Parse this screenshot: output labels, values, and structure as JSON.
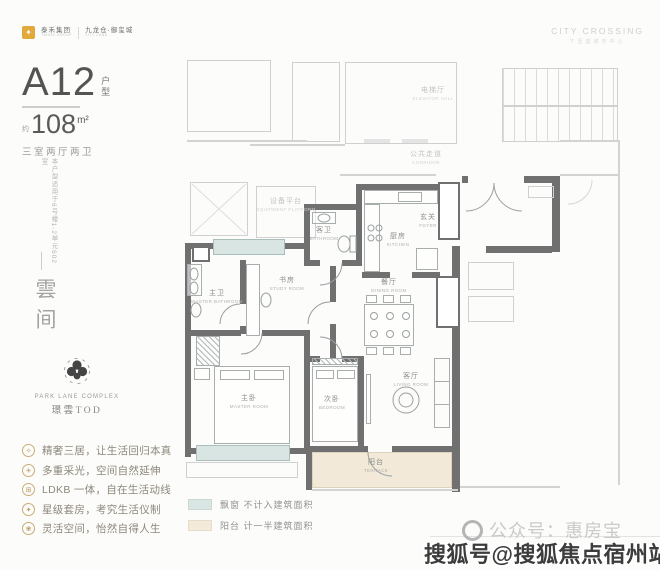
{
  "brand": {
    "logo_glyph": "✦",
    "dev_name": "泰禾集团",
    "dev_sub": "TAHOE GROUP",
    "project_name": "九龙仓·御玺城",
    "project_sub": "CITY LAND",
    "right_en": "CITY CROSSING",
    "right_cn": "下壹座城市中心"
  },
  "title": {
    "model": "A12",
    "model_tag_1": "户",
    "model_tag_2": "型",
    "approx": "约",
    "area": "108",
    "unit": "m²",
    "layout": "三室两厅两卫"
  },
  "side": {
    "note": "本户型适用于6号楼1-2单元602室",
    "name": "雲间"
  },
  "park": {
    "en": "PARK LANE COMPLEX",
    "cn": "璟雲TOD"
  },
  "features": [
    {
      "icon": "✧",
      "text": "精奢三居，让生活回归本真"
    },
    {
      "icon": "☀",
      "text": "多重采光，空间自然延伸"
    },
    {
      "icon": "⊞",
      "text": "LDKB 一体，自在生活动线"
    },
    {
      "icon": "✦",
      "text": "星级套房，考究生活仪制"
    },
    {
      "icon": "❀",
      "text": "灵活空间，怡然自得人生"
    }
  ],
  "legend": [
    {
      "color": "#d9e6e3",
      "label": "飘窗 不计入建筑面积"
    },
    {
      "color": "#f3ead9",
      "label": "阳台 计一半建筑面积"
    }
  ],
  "floorplan": {
    "rooms": [
      {
        "cn": "电梯厅",
        "en": "ELEVATOR HALL",
        "x": 433,
        "y": 94,
        "faded": true
      },
      {
        "cn": "公共走道",
        "en": "CORRIDOR",
        "x": 426,
        "y": 158,
        "faded": true
      },
      {
        "cn": "设备平台",
        "en": "EQUIPMENT PLATFORM",
        "x": 286,
        "y": 205,
        "faded": true
      },
      {
        "cn": "客卫",
        "en": "BATHROOM",
        "x": 324,
        "y": 234
      },
      {
        "cn": "厨房",
        "en": "KITCHEN",
        "x": 398,
        "y": 240
      },
      {
        "cn": "玄关",
        "en": "FOYER",
        "x": 428,
        "y": 221
      },
      {
        "cn": "餐厅",
        "en": "DINING ROOM",
        "x": 389,
        "y": 286
      },
      {
        "cn": "书房",
        "en": "STUDY ROOM",
        "x": 287,
        "y": 284
      },
      {
        "cn": "主卫",
        "en": "MASTER BATHROOM",
        "x": 217,
        "y": 297
      },
      {
        "cn": "主卧",
        "en": "MASTER ROOM",
        "x": 249,
        "y": 402
      },
      {
        "cn": "次卧",
        "en": "BEDROOM",
        "x": 332,
        "y": 403
      },
      {
        "cn": "客厅",
        "en": "LIVING ROOM",
        "x": 411,
        "y": 380
      },
      {
        "cn": "阳台",
        "en": "TERRACE",
        "x": 376,
        "y": 466
      }
    ]
  },
  "footer": {
    "account": "公众号：惠房宝",
    "watermark": "搜狐号@搜狐焦点宿州站"
  }
}
